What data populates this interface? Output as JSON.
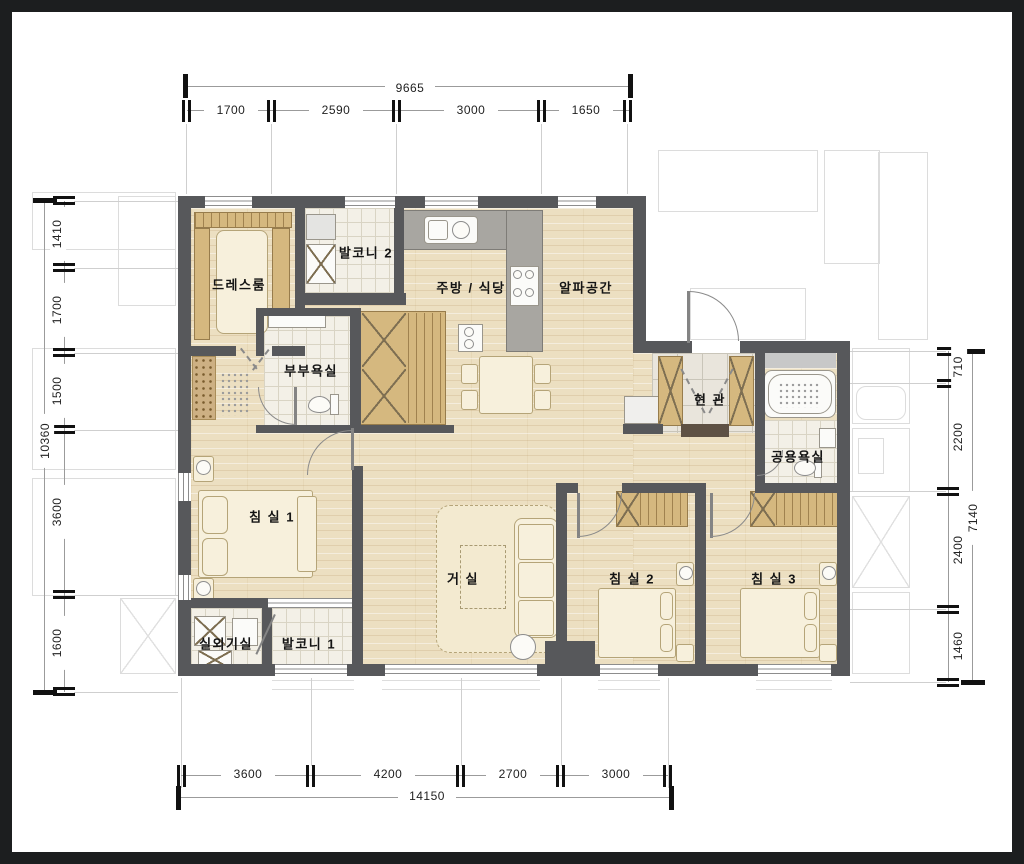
{
  "rooms": {
    "dressroom": "드레스룸",
    "balcony2": "발코니 2",
    "kitchen_dining": "주방 / 식당",
    "alpha_space": "알파공간",
    "master_bathroom": "부부욕실",
    "entrance": "현 관",
    "common_bathroom": "공용욕실",
    "bedroom1": "침 실 1",
    "living_room": "거 실",
    "bedroom2": "침 실 2",
    "bedroom3": "침 실 3",
    "outdoor_unit_room": "실외기실",
    "balcony1": "발코니 1"
  },
  "dimensions": {
    "top": {
      "total": "9665",
      "segments": [
        "1700",
        "2590",
        "3000",
        "1650"
      ]
    },
    "bottom": {
      "total": "14150",
      "segments": [
        "3600",
        "4200",
        "2700",
        "3000"
      ]
    },
    "left": {
      "total": "10360",
      "segments": [
        "1410",
        "1700",
        "1500",
        "3600",
        "1600"
      ]
    },
    "right": {
      "total": "7140",
      "segments": [
        "710",
        "2200",
        "2400",
        "1460"
      ]
    }
  },
  "colors": {
    "frame": "#1c1e1f",
    "wall": "#57585b",
    "wood_floor": "#ecdfc1",
    "closet_wood": "#d5b87f",
    "tile": "#f3f0e7",
    "counter": "#a8a6a1"
  }
}
